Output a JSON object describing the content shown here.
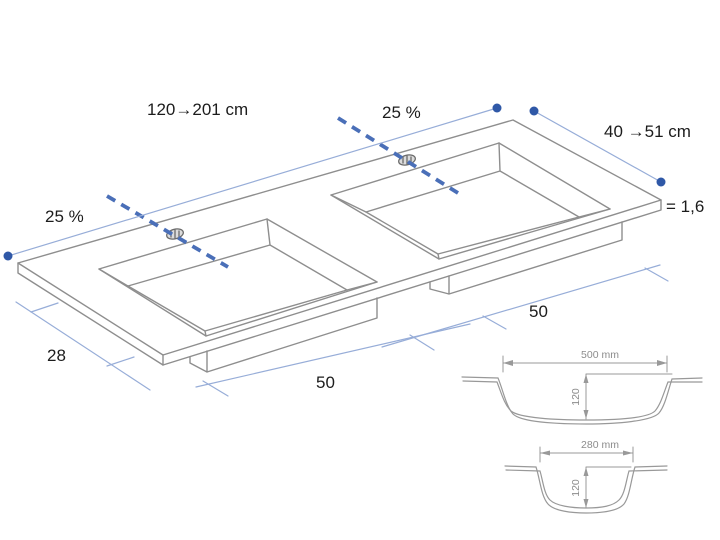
{
  "page": {
    "background": "#ffffff"
  },
  "colors": {
    "drawing_line": "#8e8e8e",
    "dim_line": "#97add8",
    "dim_dot": "#2f58a7",
    "axis_dashed": "#4a6fb8",
    "label_text": "#1c1c1c",
    "section_line": "#999999",
    "section_text": "#8c8c8c"
  },
  "labels": {
    "length_range": "120→201 cm",
    "slope_left": "25 %",
    "slope_top": "25 %",
    "depth_range": "40 →51 cm",
    "thickness": "= 1,6",
    "depth_front": "28",
    "width_bottom": "50",
    "width_right": "50"
  },
  "cross_sections": [
    {
      "width": "500 mm",
      "depth": "120"
    },
    {
      "width": "280 mm",
      "depth": "120"
    }
  ]
}
